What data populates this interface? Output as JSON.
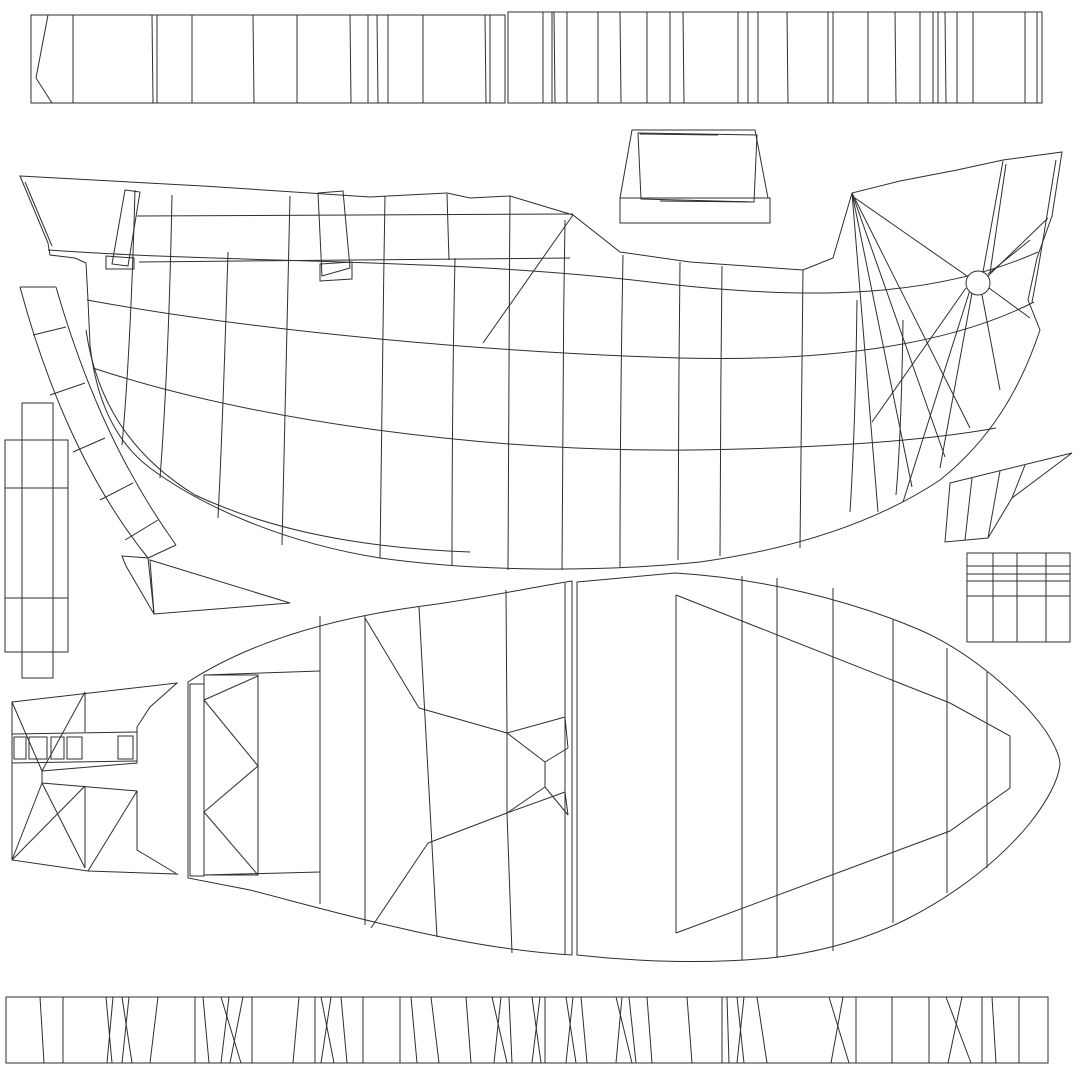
{
  "canvas": {
    "width": 1080,
    "height": 1080,
    "background": "#ffffff",
    "line_color": "#2f2f2f",
    "stroke_width": 1
  },
  "islands": [
    {
      "name": "top-plank-strip-left",
      "strip": {
        "rect": [
          31,
          15,
          474,
          88
        ],
        "dividers": [
          [
            73,
            73
          ],
          [
            152,
            153
          ],
          [
            157,
            157
          ],
          [
            192,
            192
          ],
          [
            253,
            254
          ],
          [
            297,
            297
          ],
          [
            350,
            351
          ],
          [
            368,
            368
          ],
          [
            377,
            378
          ],
          [
            388,
            388
          ],
          [
            423,
            423
          ],
          [
            485,
            486
          ],
          [
            490,
            490
          ]
        ]
      },
      "lines": [
        [
          48,
          15,
          36,
          78
        ],
        [
          36,
          78,
          52,
          103
        ]
      ]
    },
    {
      "name": "top-plank-strip-right",
      "strip": {
        "rect": [
          508,
          12,
          534,
          91
        ],
        "dividers": [
          [
            543,
            543
          ],
          [
            552,
            552
          ],
          [
            554,
            555
          ],
          [
            567,
            567
          ],
          [
            598,
            598
          ],
          [
            620,
            621
          ],
          [
            647,
            647
          ],
          [
            670,
            670
          ],
          [
            683,
            684
          ],
          [
            738,
            738
          ],
          [
            748,
            748
          ],
          [
            758,
            758
          ],
          [
            787,
            788
          ],
          [
            828,
            828
          ],
          [
            833,
            833
          ],
          [
            868,
            868
          ],
          [
            895,
            896
          ],
          [
            920,
            920
          ],
          [
            933,
            933
          ],
          [
            938,
            938
          ],
          [
            945,
            946
          ],
          [
            957,
            957
          ],
          [
            973,
            973
          ],
          [
            1025,
            1025
          ],
          [
            1037,
            1037
          ]
        ]
      }
    },
    {
      "name": "hatch-lid",
      "paths": [
        "M632,130 L755,130 L768,198 L620,198 Z",
        "M620,198 L770,198 L770,223 L620,223 Z",
        "M638,133 L757,135 L754,202 L641,199 Z"
      ],
      "lines": [
        [
          640,
          134,
          718,
          135
        ],
        [
          660,
          201,
          751,
          202
        ]
      ]
    },
    {
      "name": "hull-side-view",
      "paths": [
        "M20,176 L203,186 L370,197 L447,193 L470,198 L510,196 L573,215 L620,252 L690,262 L803,270 L833,258 L852,193 L900,181 L957,170 L1003,160 L1062,152 L1052,216 L1037,258 L1028,300 L1040,330 C1020,390 990,440 940,480 C880,520 800,548 700,562 C600,572 480,572 380,558 C280,542 200,505 150,468 C110,438 95,390 90,345 L88,300 L86,263 L75,258 L50,255 L48,243 Z",
        "M25,182 L52,246",
        "M48,250 C250,264 450,258 650,282 C800,300 930,300 1038,252",
        "M87,300 C250,330 480,352 680,358 C830,362 950,345 1034,302",
        "M93,368 C250,420 480,452 690,450 C830,448 930,440 996,428",
        "M86,330 C96,400 130,455 195,495 C270,530 360,548 470,552",
        "M137,216 L573,214",
        "M139,262 L570,258",
        "M135,190 C132,300 128,380 122,445",
        "M172,195 C170,300 166,400 160,478",
        "M228,252 C225,350 222,440 218,518",
        "M290,196 C288,320 284,440 282,545",
        "M385,196 C383,320 381,450 380,558",
        "M447,194 L449,260",
        "M455,258 C453,350 452,470 452,566",
        "M510,196 C509,330 508,470 508,570",
        "M565,220 C563,340 562,470 562,570",
        "M623,255 C621,360 620,470 620,567",
        "M680,262 C679,360 678,470 678,560",
        "M722,266 C721,360 720,470 720,556",
        "M803,270 C802,360 801,450 800,548",
        "M857,300 C856,380 854,450 850,512",
        "M903,320 C902,390 900,450 896,495",
        "M125,190 L140,192 L128,266 L112,264 Z",
        "M106,256 L134,258 L134,269 L106,269 Z",
        "M318,193 L343,191 L350,268 L322,276 Z",
        "M320,264 L352,262 L352,279 L320,281 Z",
        "M573,215 L483,343",
        "M1056,160 C1046,220 1040,262 1032,302"
      ],
      "lines": [
        [
          852,
          193,
          878,
          512
        ],
        [
          852,
          193,
          912,
          487
        ],
        [
          852,
          193,
          945,
          457
        ],
        [
          852,
          193,
          970,
          428
        ],
        [
          1003,
          161,
          983,
          272
        ],
        [
          1006,
          164,
          990,
          273
        ],
        [
          988,
          274,
          1030,
          240
        ],
        [
          989,
          288,
          1030,
          318
        ],
        [
          982,
          295,
          1000,
          390
        ],
        [
          972,
          293,
          940,
          468
        ],
        [
          970,
          290,
          903,
          502
        ],
        [
          967,
          276,
          855,
          198
        ],
        [
          987,
          277,
          1048,
          218
        ],
        [
          966,
          288,
          872,
          422
        ]
      ],
      "circles": [
        [
          978,
          283,
          12
        ]
      ]
    },
    {
      "name": "stern-skeg-strip",
      "paths": [
        "M20,287 C45,380 85,480 148,558",
        "M56,287 C80,370 115,460 176,545",
        "M150,560 L290,603 L154,614 Z",
        "M122,556 L148,558 L154,614 L126,566 Z"
      ],
      "lines": [
        [
          20,
          287,
          56,
          287
        ],
        [
          33,
          335,
          66,
          327
        ],
        [
          50,
          395,
          85,
          383
        ],
        [
          73,
          452,
          105,
          438
        ],
        [
          100,
          500,
          133,
          483
        ],
        [
          125,
          540,
          158,
          520
        ],
        [
          148,
          558,
          176,
          545
        ]
      ]
    },
    {
      "name": "rudder-post-rects",
      "rects": [
        [
          22,
          403,
          31,
          275
        ],
        [
          5,
          440,
          63,
          212
        ]
      ],
      "lines": [
        [
          5,
          488,
          68,
          488
        ],
        [
          5,
          598,
          68,
          598
        ]
      ]
    },
    {
      "name": "bow-wing-piece",
      "paths": [
        "M950,483 L1072,453 L1012,498 L988,538 L945,542 Z"
      ],
      "lines": [
        [
          972,
          478,
          965,
          540
        ],
        [
          1000,
          471,
          988,
          538
        ],
        [
          1025,
          465,
          1012,
          498
        ]
      ]
    },
    {
      "name": "detail-grid-patch",
      "rects": [
        [
          967,
          553,
          103,
          89
        ]
      ],
      "lines": [
        [
          993,
          553,
          993,
          642
        ],
        [
          1017,
          553,
          1017,
          642
        ],
        [
          1046,
          553,
          1046,
          642
        ],
        [
          967,
          566,
          1070,
          566
        ],
        [
          967,
          574,
          1070,
          574
        ],
        [
          967,
          581,
          1070,
          581
        ],
        [
          967,
          596,
          1070,
          596
        ]
      ]
    },
    {
      "name": "deck-top-left-half",
      "paths": [
        "M188,682 C250,642 330,618 430,605 C480,598 530,588 560,583 L572,581 L572,955 C520,952 460,942 400,928 C350,917 300,903 250,890 L188,878 Z",
        "M190,684 L204,684 L204,876 L190,876 Z",
        "M204,675 L258,675 L258,875 L204,875 Z",
        "M506,590 L507,733 L507,813 L512,953"
      ],
      "lines": [
        [
          204,
          700,
          258,
          676
        ],
        [
          204,
          700,
          258,
          766
        ],
        [
          204,
          812,
          258,
          766
        ],
        [
          204,
          812,
          258,
          875
        ],
        [
          320,
          616,
          320,
          904
        ],
        [
          204,
          675,
          320,
          671
        ],
        [
          204,
          875,
          320,
          872
        ],
        [
          365,
          616,
          365,
          925
        ],
        [
          419,
          607,
          437,
          937
        ],
        [
          365,
          618,
          419,
          708
        ],
        [
          419,
          708,
          507,
          733
        ],
        [
          507,
          813,
          428,
          843
        ],
        [
          428,
          843,
          371,
          928
        ],
        [
          565,
          583,
          565,
          955
        ],
        [
          507,
          733,
          565,
          717
        ],
        [
          565,
          717,
          568,
          748
        ],
        [
          568,
          748,
          545,
          762
        ],
        [
          507,
          733,
          545,
          762
        ],
        [
          545,
          762,
          545,
          787
        ],
        [
          507,
          813,
          565,
          792
        ],
        [
          565,
          792,
          568,
          815
        ],
        [
          568,
          815,
          545,
          787
        ],
        [
          507,
          813,
          545,
          787
        ]
      ]
    },
    {
      "name": "deck-top-right-half",
      "paths": [
        "M577,582 L675,573 C760,578 850,600 920,630 C970,652 1020,695 1045,730 C1055,745 1060,757 1060,765 C1058,780 1048,800 1030,823 C1000,860 955,895 905,920 C860,942 815,953 770,958 C710,964 640,962 577,955 Z",
        "M676,595 L676,933",
        "M676,595 L950,703 L1010,736 L1010,788 L950,831 L676,933"
      ],
      "lines": [
        [
          742,
          576,
          742,
          960
        ],
        [
          777,
          578,
          777,
          958
        ],
        [
          833,
          588,
          833,
          951
        ],
        [
          893,
          620,
          893,
          923
        ],
        [
          947,
          648,
          947,
          893
        ],
        [
          987,
          672,
          987,
          868
        ]
      ]
    },
    {
      "name": "stern-transom-h-piece",
      "paths": [
        "M12,702 L177,683 L150,707 L137,727 L137,763 L42,771 L42,783 L137,791 L137,850 L177,874 L88,871 L12,860 Z"
      ],
      "lines": [
        [
          12,
          734,
          137,
          732
        ],
        [
          12,
          763,
          137,
          761
        ],
        [
          85,
          692,
          85,
          732
        ],
        [
          12,
          702,
          42,
          771
        ],
        [
          85,
          692,
          42,
          771
        ],
        [
          85,
          786,
          85,
          868
        ],
        [
          12,
          860,
          85,
          786
        ],
        [
          42,
          783,
          85,
          868
        ],
        [
          137,
          791,
          88,
          871
        ],
        [
          12,
          860,
          42,
          783
        ]
      ],
      "rects": [
        [
          14,
          737,
          12,
          22
        ],
        [
          29,
          737,
          18,
          22
        ],
        [
          51,
          737,
          13,
          22
        ],
        [
          67,
          737,
          15,
          22
        ],
        [
          118,
          736,
          15,
          23
        ]
      ]
    },
    {
      "name": "bottom-plank-strip",
      "strip": {
        "rect": [
          6,
          997,
          1042,
          66
        ],
        "dividers": [
          [
            40,
            44
          ],
          [
            63,
            63
          ],
          [
            106,
            112
          ],
          [
            113,
            107
          ],
          [
            122,
            132
          ],
          [
            129,
            122
          ],
          [
            158,
            150
          ],
          [
            195,
            195
          ],
          [
            203,
            209
          ],
          [
            221,
            241
          ],
          [
            229,
            221
          ],
          [
            243,
            230
          ],
          [
            252,
            252
          ],
          [
            299,
            293
          ],
          [
            315,
            315
          ],
          [
            321,
            334
          ],
          [
            331,
            321
          ],
          [
            341,
            347
          ],
          [
            363,
            363
          ],
          [
            400,
            400
          ],
          [
            411,
            417
          ],
          [
            431,
            439
          ],
          [
            466,
            471
          ],
          [
            492,
            507
          ],
          [
            501,
            494
          ],
          [
            509,
            512
          ],
          [
            532,
            541
          ],
          [
            540,
            532
          ],
          [
            545,
            545
          ],
          [
            566,
            576
          ],
          [
            573,
            566
          ],
          [
            581,
            587
          ],
          [
            616,
            632
          ],
          [
            622,
            616
          ],
          [
            629,
            636
          ],
          [
            647,
            652
          ],
          [
            687,
            692
          ],
          [
            722,
            722
          ],
          [
            727,
            729
          ],
          [
            737,
            744
          ],
          [
            744,
            737
          ],
          [
            757,
            767
          ],
          [
            829,
            849
          ],
          [
            843,
            831
          ],
          [
            856,
            856
          ],
          [
            892,
            892
          ],
          [
            929,
            929
          ],
          [
            946,
            971
          ],
          [
            962,
            948
          ],
          [
            982,
            982
          ],
          [
            992,
            996
          ],
          [
            1019,
            1019
          ]
        ]
      }
    }
  ]
}
